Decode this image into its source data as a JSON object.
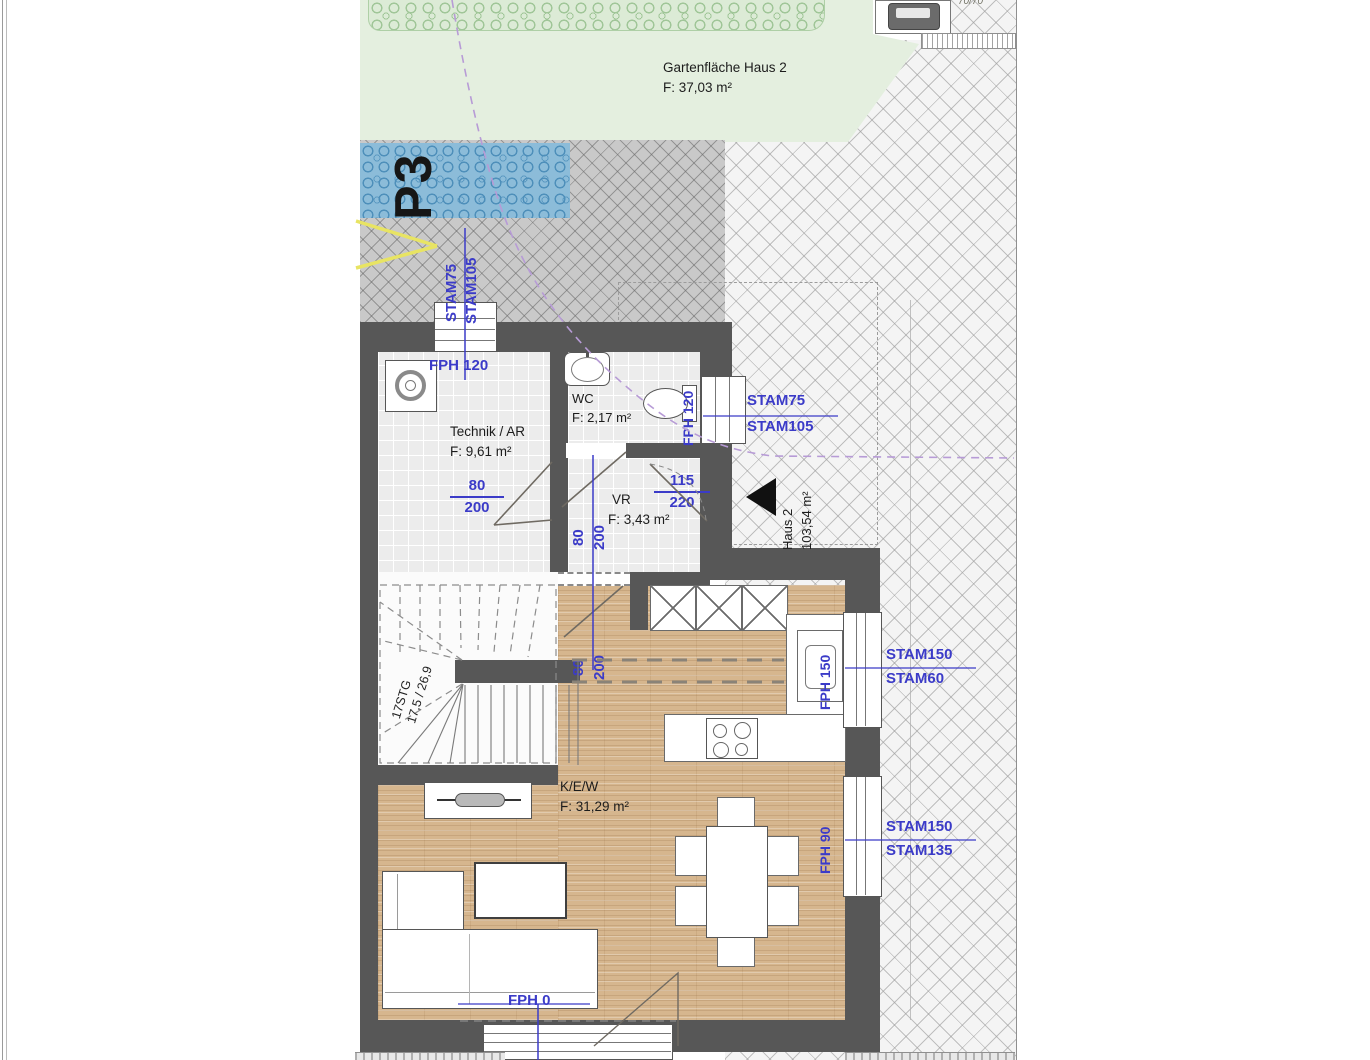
{
  "colors": {
    "dim_blue": "#3b3bc8",
    "wall_gray": "#575757",
    "guide_purple": "#b79bd6",
    "marking_yellow": "#e8e463",
    "wood": "#d6b68e"
  },
  "garden": {
    "title": "Gartenfläche Haus 2",
    "area": "F: 37,03 m²"
  },
  "parking": {
    "label": "P3",
    "dim1": "STAM75",
    "dim2": "STAM105"
  },
  "corner_item": {
    "size": "70/70"
  },
  "rooms": {
    "technik": {
      "name": "Technik / AR",
      "area": "F: 9,61 m²",
      "window_label": "FPH 120"
    },
    "wc": {
      "name": "WC",
      "area": "F: 2,17 m²",
      "side_label": "FPH 120"
    },
    "vr": {
      "name": "VR",
      "area": "F: 3,43 m²"
    },
    "kew": {
      "name": "K/E/W",
      "area": "F: 31,29 m²"
    }
  },
  "entrance": {
    "dim1": "STAM75",
    "dim2": "STAM105",
    "house": "Haus 2",
    "house_area": "103,54 m²",
    "door_w": "115",
    "door_h": "220"
  },
  "doors": {
    "technik_w": "80",
    "technik_h": "200",
    "vr_w": "80",
    "vr_h": "200",
    "kitchen_w": "80",
    "kitchen_h": "200"
  },
  "stairs": {
    "line1": "17STG",
    "line2": "17,5 / 26,9"
  },
  "kitchen": {
    "window_label": "FPH 150",
    "dim1": "STAM150",
    "dim2": "STAM60"
  },
  "dining": {
    "window_label": "FPH 90",
    "dim1": "STAM150",
    "dim2": "STAM135"
  },
  "terrace_door": {
    "label": "FPH 0"
  }
}
